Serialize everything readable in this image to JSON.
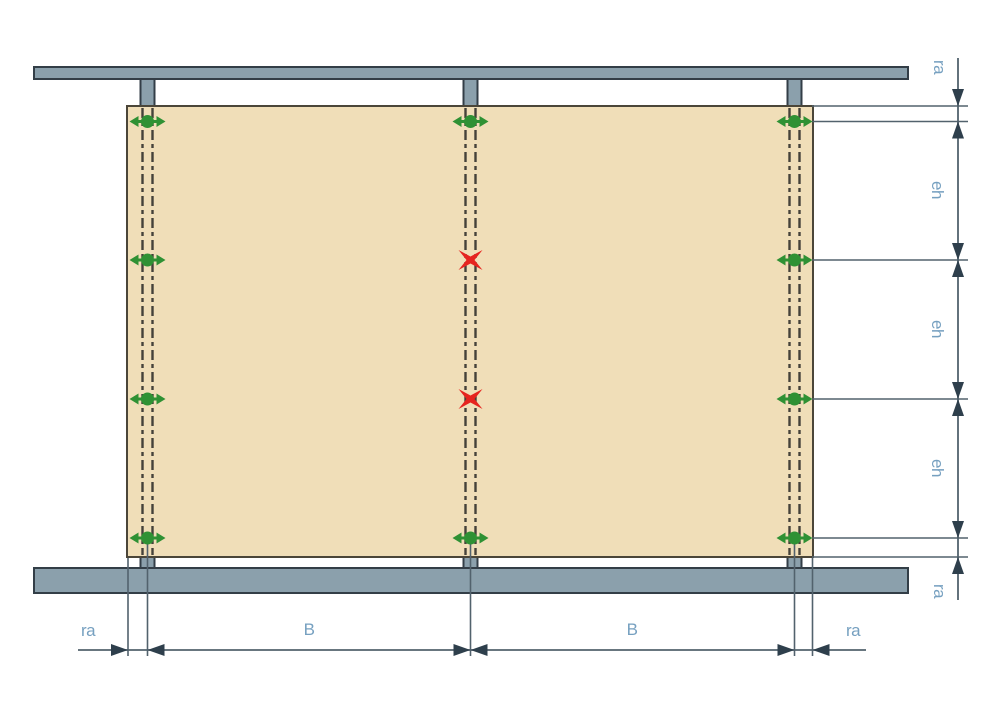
{
  "dims": {
    "bottom": [
      "ra",
      "B",
      "B",
      "ra"
    ],
    "right": [
      "ra",
      "eh",
      "eh",
      "eh",
      "ra"
    ]
  },
  "fasteners": [
    {
      "column": "left",
      "row": 1,
      "type": "fastener"
    },
    {
      "column": "left",
      "row": 2,
      "type": "fastener"
    },
    {
      "column": "left",
      "row": 3,
      "type": "fastener"
    },
    {
      "column": "left",
      "row": 4,
      "type": "fastener"
    },
    {
      "column": "center",
      "row": 1,
      "type": "fastener"
    },
    {
      "column": "center",
      "row": 2,
      "type": "blocked"
    },
    {
      "column": "center",
      "row": 3,
      "type": "blocked"
    },
    {
      "column": "center",
      "row": 4,
      "type": "fastener"
    },
    {
      "column": "right",
      "row": 1,
      "type": "fastener"
    },
    {
      "column": "right",
      "row": 2,
      "type": "fastener"
    },
    {
      "column": "right",
      "row": 3,
      "type": "fastener"
    },
    {
      "column": "right",
      "row": 4,
      "type": "fastener"
    }
  ],
  "icons": {
    "fastener": "green-fastening-point-icon",
    "blocked": "red-x-marker-icon"
  },
  "colors": {
    "panel": "#f0deb8",
    "panel_border": "#4b4639",
    "beam": "#8ba0ac",
    "beam_border": "#333e47",
    "line": "#52626d",
    "arrow": "#2e3f4c",
    "label": "#76a0c0",
    "green": "#2f9134",
    "red": "#e6241f",
    "centerline": "#45423a"
  }
}
